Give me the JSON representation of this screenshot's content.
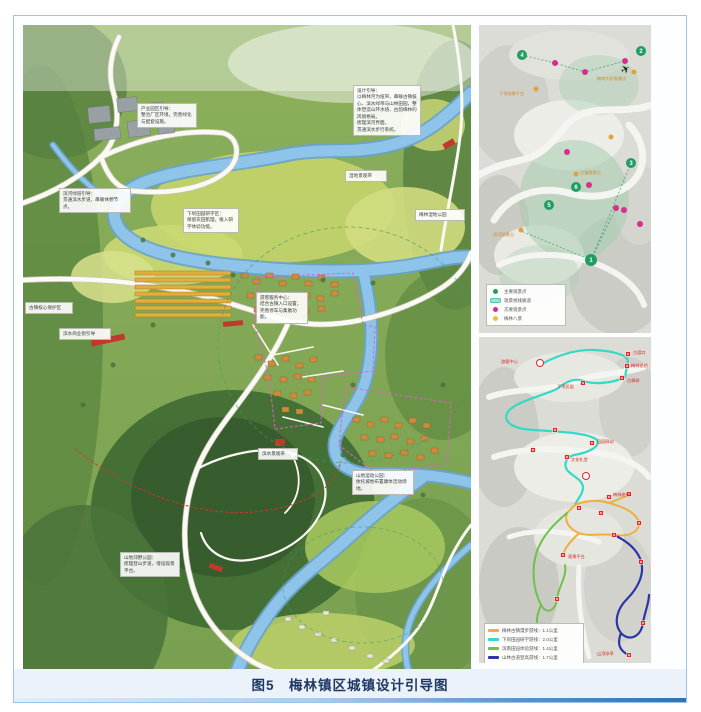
{
  "caption": "图5　梅林镇区城镇设计引导图",
  "colors": {
    "frame_border": "#9DC3E6",
    "caption_color": "#1F3864",
    "caption_bg": "#EBF2FA",
    "bottom_bar_gradient": [
      "#E4EEF8",
      "#2E74B5"
    ],
    "river": "#8FC4EA",
    "road": "#FAF9F4",
    "boundary_magenta": "#E25FC8",
    "trail_red": "#C8392B",
    "viewline_green": "#2E9E6B"
  },
  "main_map": {
    "annotations": [
      {
        "text": "设计引导：\n以梅林河为纽带，串联古镇核心、滨水绿带与山林田园，整体塑造山环水绕、古韵梅林的风貌格局。\n梳理滨河界面，\n贯通滨水步行系统。"
      },
      {
        "text": "产业园区引导：\n整治厂区环境，完善绿化与配套设施。"
      },
      {
        "text": "滨河绿道引导：\n贯通滨水步道，串联休憩节点。"
      },
      {
        "text": "下坝田园研学区：\n保留农田肌理，植入研学体验功能。"
      },
      {
        "text": "梅林湿地公园"
      },
      {
        "text": "游客服务中心：\n结合古镇入口设置，完善停车与集散功能。"
      },
      {
        "text": "滨水商业街引导"
      },
      {
        "text": "古镇核心保护区"
      },
      {
        "text": "山地郊野公园：\n梳理登山步道，增设观景平台。"
      },
      {
        "text": "山地运动公园：\n依托坡地布置康体活动场地。"
      },
      {
        "text": "滨水景观带"
      },
      {
        "text": "湿地景观带"
      }
    ]
  },
  "top_map": {
    "points": [
      {
        "num": "1"
      },
      {
        "num": "2"
      },
      {
        "num": "3"
      },
      {
        "num": "4"
      },
      {
        "num": "5"
      },
      {
        "num": "6"
      }
    ],
    "point_labels": [
      "下坝观景平台",
      "梅林大桥观景点",
      "古镇揽胜点",
      "滨河观景点"
    ],
    "legend": {
      "items": [
        {
          "label": "主要观景点",
          "color": "#1E9E63"
        },
        {
          "label": "观景视线廊道",
          "color": "#9FE2D5"
        },
        {
          "label": "次要观景点",
          "color": "#D6308C"
        },
        {
          "label": "梅林八景",
          "color": "#E3C23C"
        }
      ]
    }
  },
  "bottom_map": {
    "poi_labels": [
      "古渡口",
      "梅林老桥",
      "古樟树",
      "下坝民居",
      "田园驿站",
      "梅林老街",
      "游客中心",
      "文化礼堂",
      "观景平台",
      "山顶凉亭"
    ],
    "legend": {
      "items": [
        {
          "label": "梅林古镇漫步游线：1.1公里",
          "color": "#EFAF3C"
        },
        {
          "label": "下坝田园研学游线：2.0公里",
          "color": "#35D9C5"
        },
        {
          "label": "滨南田园体验游线：1.4公里",
          "color": "#6CC24A"
        },
        {
          "label": "山林古道登高游线：1.7公里",
          "color": "#2C35A8"
        }
      ]
    }
  }
}
